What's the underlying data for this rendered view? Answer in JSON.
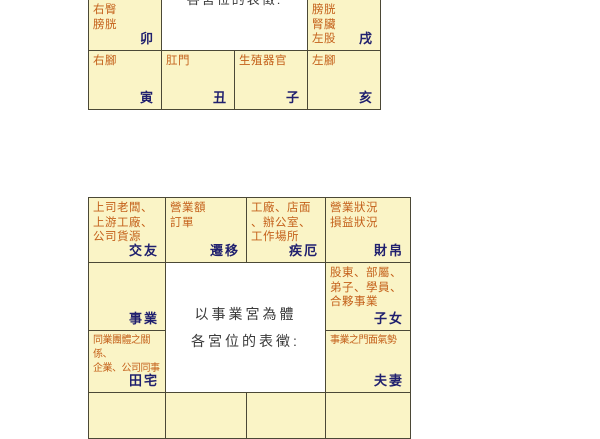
{
  "colors": {
    "cell_background": "#faf4c6",
    "grid_line": "#4b4836",
    "content_text": "#c4611b",
    "palace_label_text": "#20206e",
    "caption_text": "#3a3a3a"
  },
  "top_chart": {
    "center_caption_cut": "各宮位的表徵:",
    "cells": {
      "mao": {
        "content": "右臀\n膀胱",
        "branch": "卯"
      },
      "xu": {
        "content": "膀胱\n腎臟\n左股",
        "branch": "戌"
      },
      "yin": {
        "content": "右腳",
        "branch": "寅"
      },
      "chou": {
        "content": "肛門",
        "branch": "丑"
      },
      "zi": {
        "content": "生殖器官",
        "branch": "子"
      },
      "hai": {
        "content": "左腳",
        "branch": "亥"
      }
    }
  },
  "bottom_chart": {
    "center_caption_line1": "以事業宮為體",
    "center_caption_line2": "各宮位的表徵:",
    "cells": {
      "jiaoyou": {
        "content": "上司老闆、\n上游工廠、\n公司貨源",
        "palace": "交友"
      },
      "qianyi": {
        "content": "營業額\n訂單",
        "palace": "遷移"
      },
      "jie": {
        "content": "工廠、店面\n、辦公室、\n工作場所",
        "palace": "疾厄"
      },
      "caibo": {
        "content": "營業狀況\n損益狀況",
        "palace": "財帛"
      },
      "shiye": {
        "content": "",
        "palace": "事業"
      },
      "zinv": {
        "content": "股東、部屬、\n弟子、學員、\n合夥事業",
        "palace": "子女"
      },
      "tianzhai": {
        "content": "同業團體之關係、\n企業、公司同事",
        "palace": "田宅"
      },
      "fuqi": {
        "content": "事業之門面氣勢",
        "palace": "夫妻"
      }
    }
  }
}
